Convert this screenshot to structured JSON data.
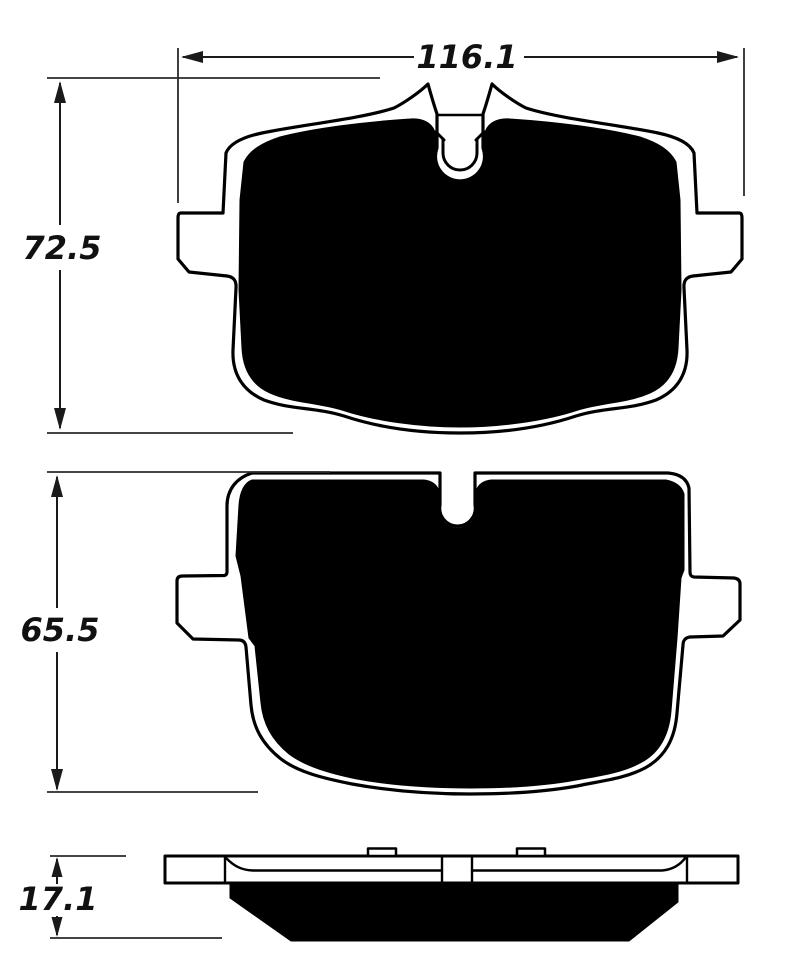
{
  "canvas": {
    "width": 788,
    "height": 964,
    "background": "#ffffff"
  },
  "colors": {
    "outline": "#000000",
    "friction_fill": "#000000",
    "dimension_line": "#1a1a1a",
    "label_text": "#111111"
  },
  "dimensions": {
    "width": "116.1",
    "height_view1": "72.5",
    "height_view2": "65.5",
    "thickness": "17.1"
  }
}
